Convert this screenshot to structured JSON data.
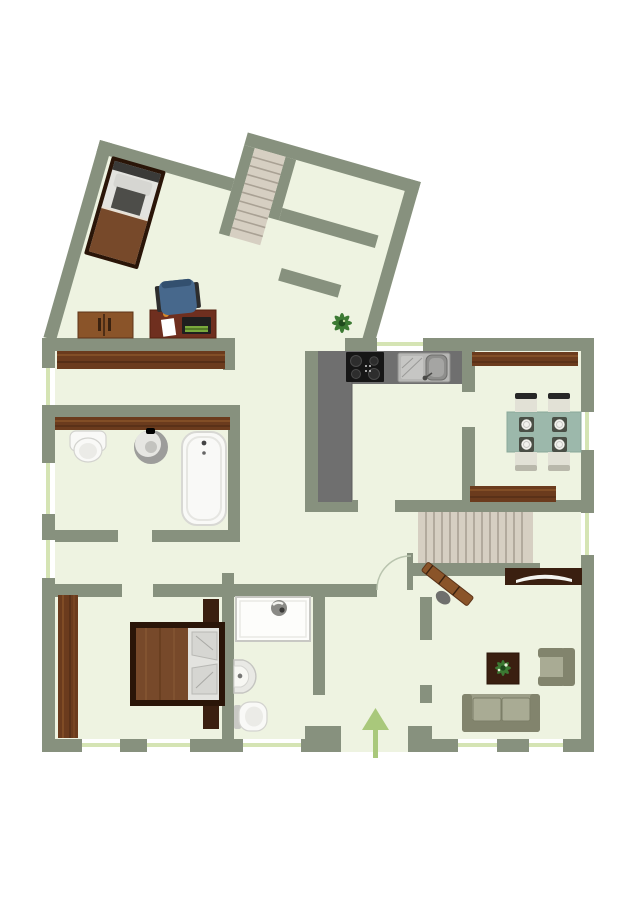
{
  "meta": {
    "title": "Apartment floor plan (top view)",
    "type": "floorplan",
    "view": "2d-top-down",
    "has_visible_text": false
  },
  "colors": {
    "bg": "#ffffff",
    "wall": "#87917e",
    "floor": "#eef3e1",
    "windowLine": "#d5e4b4",
    "wood": "#6b3b1d",
    "woodLight": "#8a5429",
    "woodDark": "#3a1f10",
    "woodDeep": "#2a1508",
    "counter": "#6f6f6f",
    "cooktopBlack": "#161616",
    "steel": "#b7b7b5",
    "steelDark": "#8e8e8c",
    "tableTeal": "#9cb8ab",
    "chairCream": "#e2e1d6",
    "chairDark": "#262626",
    "chairGray": "#b9b8ab",
    "sofaBase": "#9c9e88",
    "sofaShade": "#82846d",
    "sofaCushion": "#a9ab94",
    "stairTread": "#d6cfc2",
    "stairLine": "#a9a194",
    "fixtureWhite": "#f9f9f7",
    "fixtureStroke": "#d3d3cf",
    "arrowGreen": "#a9c87b",
    "officeChairBlue": "#47688c",
    "plantGreen": "#3c7a33",
    "blanketBrown": "#77492a",
    "bedSheet": "#e3e3df",
    "pillowGray": "#d6d6d2",
    "duvetGray": "#4d4d49"
  },
  "rooms": [
    {
      "id": "angled-wing-room",
      "furniture": [
        "single-bed",
        "desk",
        "office-chair",
        "dresser",
        "upper-staircase",
        "inner-room"
      ]
    },
    {
      "id": "hallway-top",
      "furniture": [
        "wardrobe-strip",
        "wardrobe-strip"
      ]
    },
    {
      "id": "bathroom",
      "furniture": [
        "toilet",
        "round-sink",
        "bathtub"
      ]
    },
    {
      "id": "kitchen",
      "furniture": [
        "l-counter",
        "cooktop",
        "double-sink"
      ]
    },
    {
      "id": "dining-room",
      "furniture": [
        "sideboard",
        "sideboard",
        "dining-table",
        "chair",
        "chair",
        "chair",
        "chair"
      ]
    },
    {
      "id": "stair-hall",
      "furniture": [
        "staircase",
        "coat-rack",
        "tv-lowboard",
        "entrance-arrow"
      ]
    },
    {
      "id": "bedroom",
      "furniture": [
        "wardrobe",
        "double-bed",
        "nightstand",
        "nightstand"
      ]
    },
    {
      "id": "shower-room",
      "furniture": [
        "shower-stall",
        "corner-sink",
        "toilet"
      ]
    },
    {
      "id": "living-room",
      "furniture": [
        "sofa",
        "armchair",
        "coffee-table-with-plant"
      ]
    }
  ],
  "annotations": {
    "entrance": "arrow pointing up at bottom-center",
    "windows": "light green lines in exterior walls",
    "plants": [
      "corridor-plant",
      "coffee-table-plant"
    ]
  }
}
